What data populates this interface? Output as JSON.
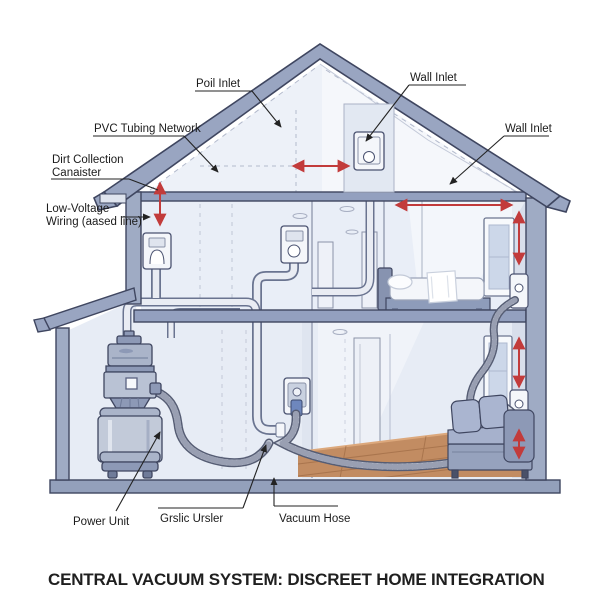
{
  "title": "CENTRAL VACUUM SYSTEM: DISCREET HOME INTEGRATION",
  "labels": {
    "poil_inlet": "Poil Inlet",
    "wall_inlet_top": "Wall Inlet",
    "wall_inlet_right": "Wall Inlet",
    "pvc_tubing_network": "PVC Tubing Network",
    "dirt_collection_1": "Dirt Collection",
    "dirt_collection_2": "Canaister",
    "low_voltage_1": "Low-Voltage",
    "low_voltage_2": "Wiring (aased line)",
    "power_unit": "Power Unit",
    "grslic_ursler": "Grslic Ursler",
    "vacuum_hose": "Vacuum Hose"
  },
  "colors": {
    "arrow_red": "#c23b3b",
    "roof_slate": "#99a5c1",
    "band_slate": "#93a0bf",
    "wall_fill": "#e9eef7",
    "wood_floor": "#c28c62",
    "leader_line": "#232323",
    "outline_dark": "#3f4660"
  }
}
